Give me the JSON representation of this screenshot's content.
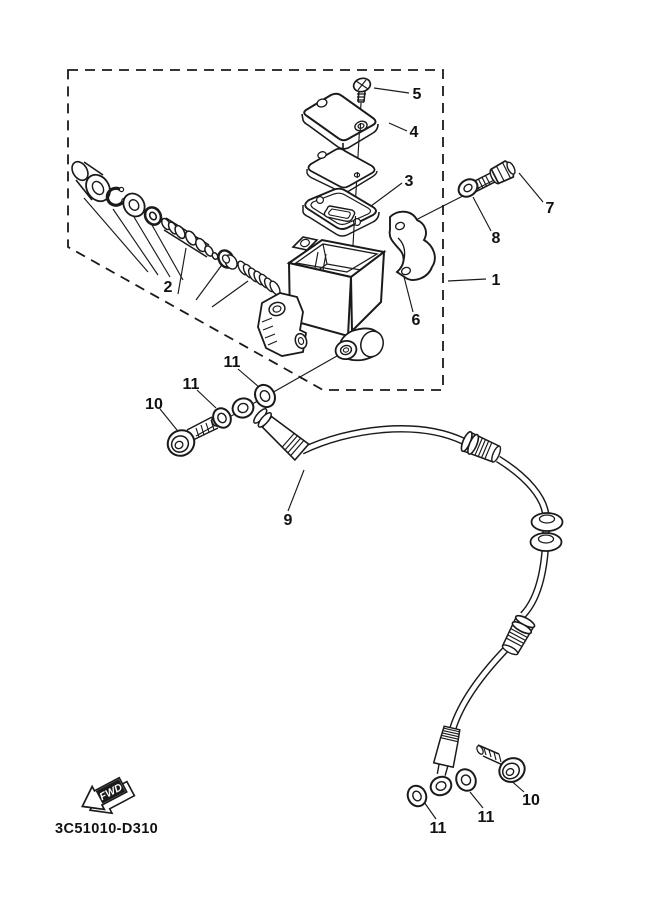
{
  "diagram": {
    "callouts": {
      "n1": "1",
      "n2": "2",
      "n3": "3",
      "n4": "4",
      "n5": "5",
      "n6": "6",
      "n7": "7",
      "n8": "8",
      "n9": "9",
      "n10_top": "10",
      "n10_bottom": "10",
      "n11_top_right": "11",
      "n11_top_left": "11",
      "n11_bottom_left": "11",
      "n11_bottom_mid": "11"
    },
    "fwd_label": "FWD",
    "part_code": "3C51010-D310",
    "colors": {
      "line": "#1a1a1a",
      "background": "#ffffff"
    }
  }
}
